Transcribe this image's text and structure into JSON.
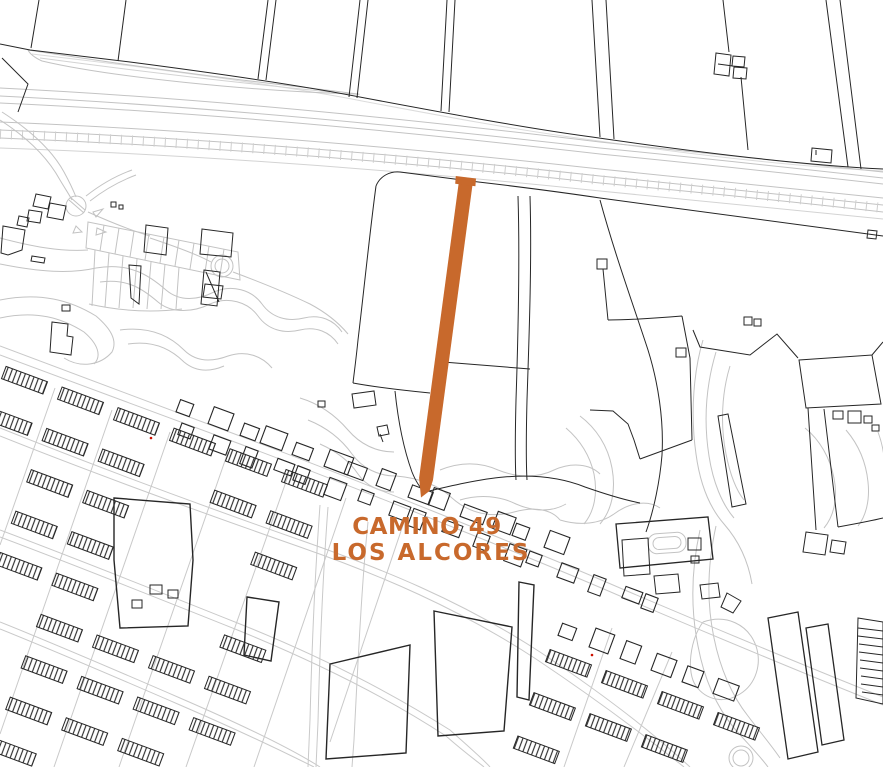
{
  "highlight": {
    "line1": "CAMINO 49",
    "line2": "LOS ALCORES",
    "color": "#C8692C"
  },
  "palette": {
    "background": "#ffffff",
    "line_black": "#262626",
    "line_gray": "#c3c3c3",
    "shadow_gray": "#dcdcdc",
    "red_dot": "#cc1100"
  }
}
